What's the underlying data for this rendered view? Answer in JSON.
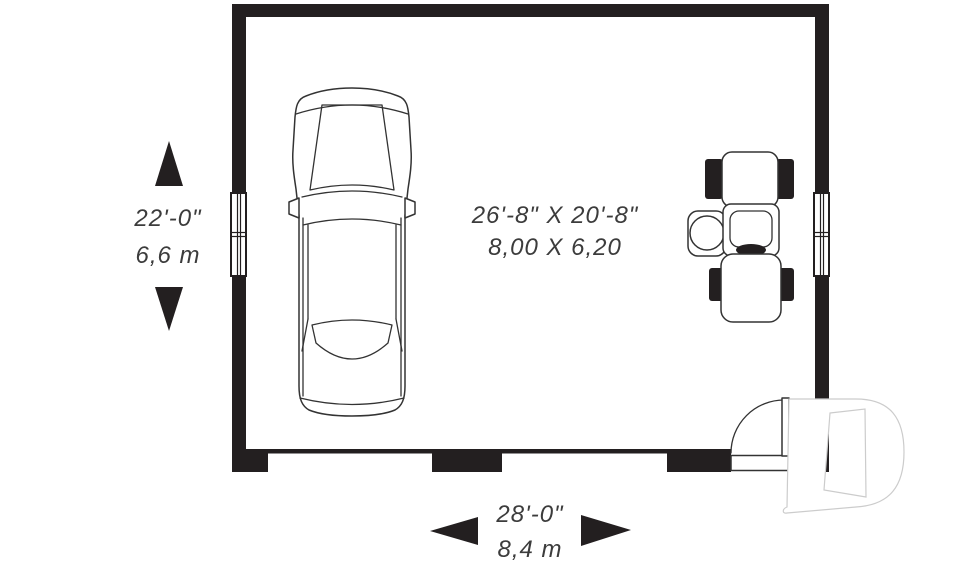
{
  "room_label": {
    "imperial": "26'-8\" X 20'-8\"",
    "metric": "8,00 X 6,20"
  },
  "dimensions": {
    "depth": {
      "imperial": "22'-0\"",
      "metric": "6,6 m"
    },
    "width": {
      "imperial": "28'-0\"",
      "metric": "8,4 m"
    }
  },
  "icons": {
    "car": "car-top-view-icon",
    "tractor": "lawn-tractor-icon",
    "door": "entry-door-swing-icon",
    "watermark": "letter-d-watermark-logo",
    "arrows": [
      "dim-arrow-up",
      "dim-arrow-down",
      "dim-arrow-left",
      "dim-arrow-right"
    ]
  },
  "colors": {
    "wall": "#231f20",
    "line": "#333333",
    "text": "#3c3c3c",
    "logo": "#cccccc",
    "background": "#ffffff"
  }
}
